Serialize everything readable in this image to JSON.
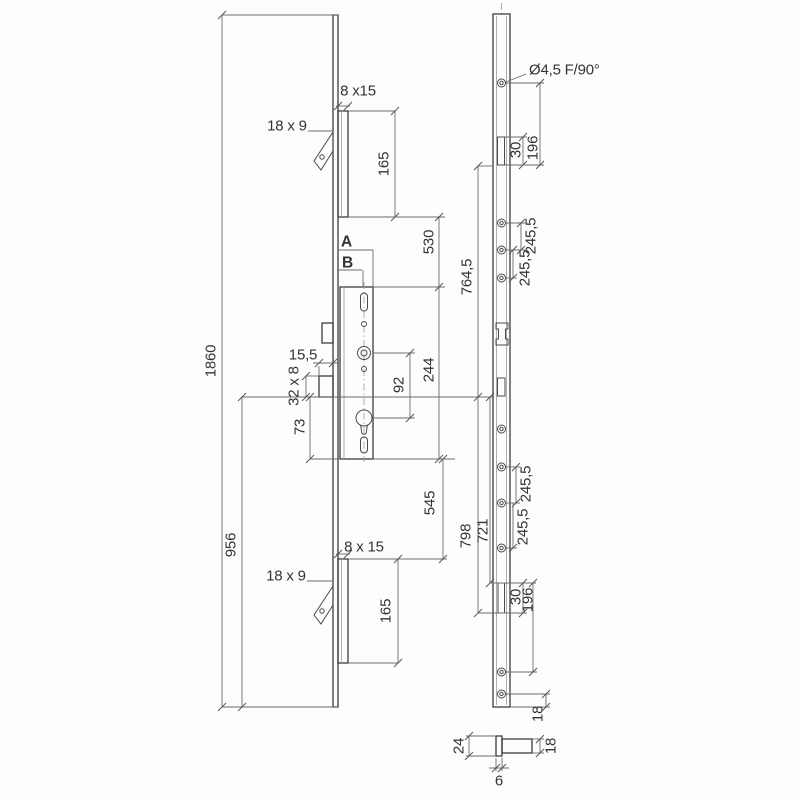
{
  "colors": {
    "background": "#fdfdfd",
    "part_line": "#3c3c3c",
    "dim_line": "#6b6b6b",
    "text": "#333333"
  },
  "side_view": {
    "overall_height": "1860",
    "bottom_section_height": "956",
    "top_extension_label": "8 x15",
    "top_hook_label": "18 x 9",
    "top_extension_length": "165",
    "ref_a": "A",
    "ref_b": "B",
    "extension_to_case": "530",
    "case_height": "244",
    "follower_to_cylinder": "92",
    "deadbolt_throw": "15,5",
    "deadbolt_label": "32 x 8",
    "cylinder_to_case_bottom": "73",
    "case_to_bottom_extension": "545",
    "bottom_extension_label": "8 x 15",
    "bottom_hook_label": "18 x 9",
    "bottom_extension_length": "165"
  },
  "front_view": {
    "screw_hole_spec": "Ø4,5 F/90°",
    "top_slot_length": "30",
    "top_slot_pitch": "196",
    "hole_pitch_1": "245,5",
    "hole_pitch_2": "245,5",
    "hole_pitch_3": "245,5",
    "hole_pitch_4": "245,5",
    "upper_span": "764,5",
    "lower_span_outer": "798",
    "lower_span_inner": "721",
    "bottom_slot_length": "30",
    "bottom_slot_pitch": "196",
    "end_distance": "18"
  },
  "section_view": {
    "faceplate_width": "24",
    "channel_depth": "18",
    "faceplate_thickness": "6"
  }
}
